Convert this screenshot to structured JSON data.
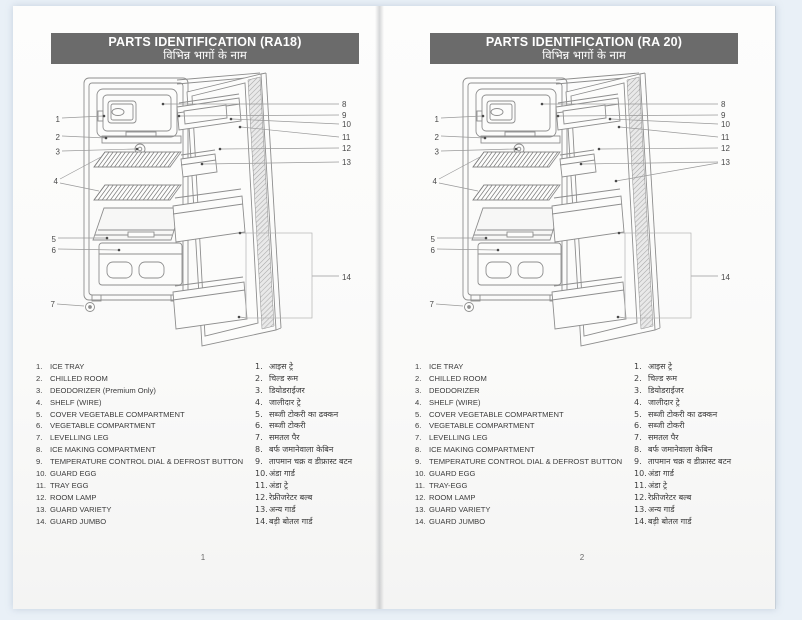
{
  "colors": {
    "canvas_bg": "#e9f0f7",
    "page_bg": "#fbfbfa",
    "header_bg": "#6b6b6b",
    "header_text": "#ffffff",
    "diagram_line": "#8e8e8e",
    "list_text": "#3c3c3c"
  },
  "pages": [
    {
      "title": "PARTS IDENTIFICATION (RA18)",
      "subtitle": "विभिन्न भागों के नाम",
      "page_number": "1",
      "parts_en": [
        "ICE TRAY",
        "CHILLED ROOM",
        "DEODORIZER (Premium Only)",
        "SHELF (WIRE)",
        "COVER VEGETABLE COMPARTMENT",
        "VEGETABLE COMPARTMENT",
        "LEVELLING LEG",
        "ICE MAKING COMPARTMENT",
        "TEMPERATURE CONTROL DIAL & DEFROST BUTTON",
        "GUARD EGG",
        "TRAY EGG",
        "ROOM LAMP",
        "GUARD VARIETY",
        "GUARD JUMBO"
      ],
      "parts_hi": [
        "आइस ट्रे",
        "चिल्ड रूम",
        "डियोडराईजर",
        "जालीदार ट्रे",
        "सब्जी टोकरी का ढक्कन",
        "सब्जी टोकरी",
        "समतल पैर",
        "बर्फ जमानेवाला केबिन",
        "तापमान चक्र व डीफ्रास्ट बटन",
        "अंडा गार्ड",
        "अंडा ट्रे",
        "रेफ्रीजरेटर बल्ब",
        "अन्य गार्ड",
        "बड़ी बोतल गार्ड"
      ]
    },
    {
      "title": "PARTS IDENTIFICATION (RA 20)",
      "subtitle": "विभिन्न भागों के नाम",
      "page_number": "2",
      "parts_en": [
        "ICE TRAY",
        "CHILLED ROOM",
        "DEODORIZER",
        "SHELF (WIRE)",
        "COVER VEGETABLE COMPARTMENT",
        "VEGETABLE COMPARTMENT",
        "LEVELLING LEG",
        "ICE MAKING COMPARTMENT",
        "TEMPERATURE CONTROL DIAL & DEFROST BUTTON",
        "GUARD EGG",
        "TRAY-EGG",
        "ROOM LAMP",
        "GUARD VARIETY",
        "GUARD JUMBO"
      ],
      "parts_hi": [
        "आइस ट्रे",
        "चिल्ड रूम",
        "डियोडराईजर",
        "जालीदार ट्रे",
        "सब्जी टोकरी का ढक्कन",
        "सब्जी टोकरी",
        "समतल पैर",
        "बर्फ जमानेवाला केबिन",
        "तापमान चक्र व डीफ्रास्ट बटन",
        "अंडा गार्ड",
        "अंडा ट्रे",
        "रेफ्रीजरेटर बल्ब",
        "अन्य गार्ड",
        "बड़ी बोतल गार्ड"
      ]
    }
  ],
  "diagram": {
    "callouts_left": [
      "1",
      "2",
      "3",
      "4",
      "5",
      "6",
      "7"
    ],
    "callouts_right": [
      "8",
      "9",
      "10",
      "11",
      "12",
      "13",
      "14"
    ]
  }
}
